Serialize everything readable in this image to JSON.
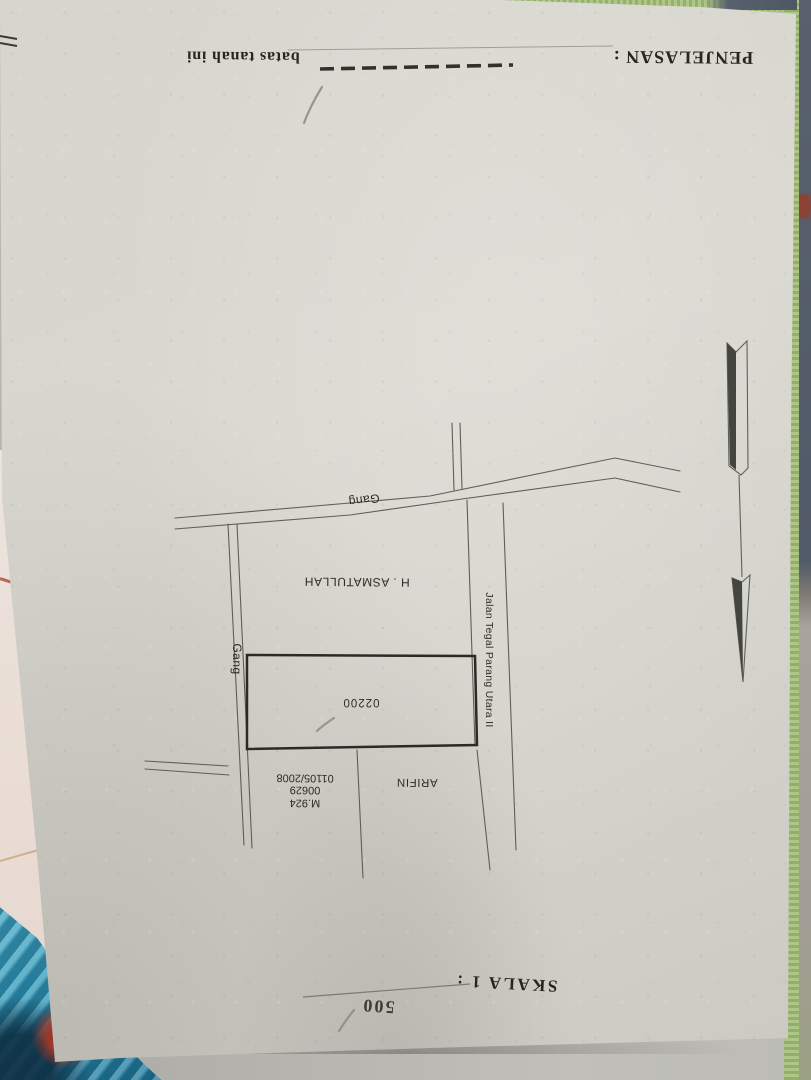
{
  "document": {
    "legend": {
      "title": "PENJELASAN :",
      "boundary_label": "batas tanah ini"
    },
    "scale": {
      "label": "SKALA 1 :",
      "value": "500"
    },
    "sketch": {
      "plot_number": "02200",
      "owner": "H . ASMATULLAH",
      "neighbor": "ARIFIN",
      "certificate": {
        "line1": "M.924",
        "line2": "00629",
        "line3": "01105/2008"
      },
      "roads": {
        "gang_top": "Gang",
        "gang_left": "Gang",
        "main_street": "Jalan Tegal Parang Utara II"
      }
    },
    "colors": {
      "paper": "#d7d6ce",
      "ink": "#2b2b26",
      "green_mat": "#a3bd79",
      "blue_fabric": "#2f96b6",
      "dark_cloth": "#59616e"
    }
  }
}
